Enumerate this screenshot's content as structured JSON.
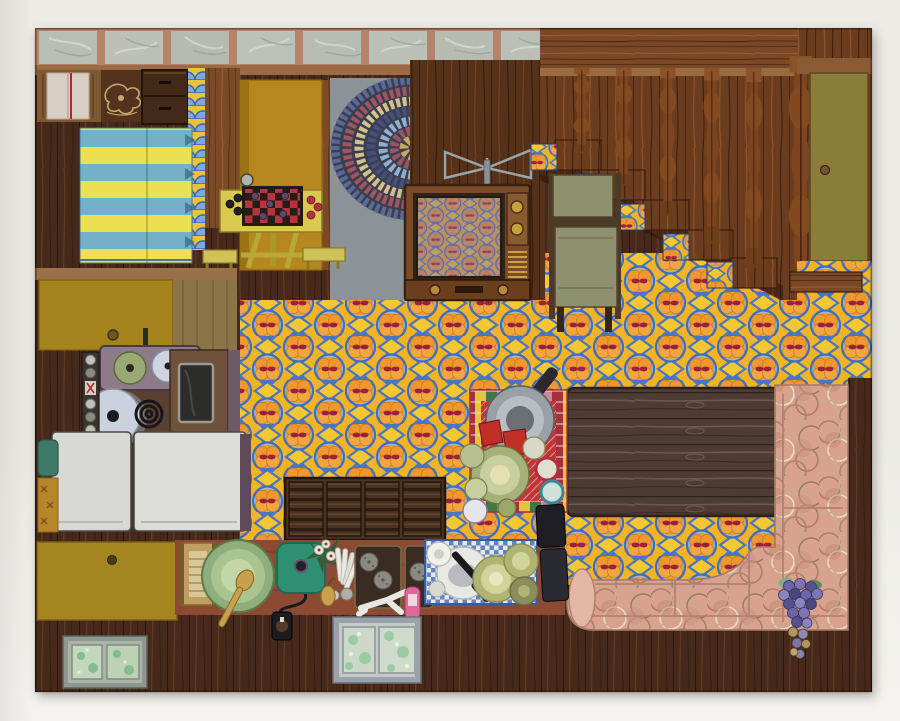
{
  "artwork": {
    "description": "Folk-art painting of a house interior seen from above: striped bed and checkers table in a bedroom, braided rug, wooden television, carpeted staircase with turned balusters, olive door, retro orange-and-blue patterned floor, kitchen with stove pots and white refrigerator doors, plank coffee table with dishes on a red checked mat, pink circle-patterned sectional sofa with grapes, counters with green tray, teal griddle, sink, plates and a window pane, hung on a white gallery wall.",
    "medium_hint": "painting on panel",
    "orientation": "landscape"
  },
  "palette": {
    "wall": "#ecebe6",
    "wallLower": "#f4f3ef",
    "woodDark": "#46291a",
    "woodMedium": "#7b4a27",
    "woodPanel": "#563119",
    "woodStair": "#75431f",
    "woodLanding": "#7b4826",
    "tableWood": "#4e3c34",
    "tileMarble": "#b9beb5",
    "tileGrout": "#b5836a",
    "floorYellow": "#f0b424",
    "floorOrange": "#ee9d2f",
    "floorBlue": "#4a74c4",
    "floorRed": "#9c1f3c",
    "bedTeal": "#74b0c8",
    "bedYellow": "#ecdf52",
    "mustardBed": "#b5871c",
    "cabinetMustard": "#a5851f",
    "kitchenCounter": "#a5841e",
    "grayFloor": "#8b9398",
    "fridgeWhite": "#d8d8d4",
    "ovenBrown": "#6e523c",
    "burnerBox": "#8d7b89",
    "sofaPink": "#d9a28f",
    "sofaSeam": "#b3806e",
    "counterRed": "#8c4a33",
    "griddleTeal": "#2f8f72",
    "trayGreen": "#a9c490",
    "checkerTableYellow": "#d9c94e",
    "checkerRed": "#b53440",
    "checkerBlack": "#281c14",
    "trivetRed": "#c23535",
    "doorOlive": "#8c7c3a",
    "chairOlive": "#8f9070",
    "grapeViolet": "#6a64a8",
    "frameGray": "#8e988e",
    "windowGray": "#9ca2aa",
    "panGray": "#9aa0a6",
    "rugBlue": "#5a6a94",
    "rugRed": "#a05560",
    "rugCream": "#d2c08a"
  },
  "scene": {
    "items": [
      {
        "name": "tiled-ledge",
        "label": "marble tile ledge"
      },
      {
        "name": "dresser-with-towel",
        "label": "dresser with towel"
      },
      {
        "name": "carved-panel",
        "label": "carved wood panel"
      },
      {
        "name": "nightstand",
        "label": "nightstand"
      },
      {
        "name": "striped-bed",
        "label": "blue and yellow striped bed"
      },
      {
        "name": "mustard-bed",
        "label": "mustard bedspread"
      },
      {
        "name": "checkers-table",
        "label": "checkers game table with benches"
      },
      {
        "name": "braided-rug",
        "label": "oval braided rug"
      },
      {
        "name": "television",
        "label": "wooden television with antenna"
      },
      {
        "name": "staircase",
        "label": "staircase with turned balusters"
      },
      {
        "name": "folding-chair",
        "label": "olive folding chair"
      },
      {
        "name": "door",
        "label": "olive door"
      },
      {
        "name": "patterned-floor",
        "label": "orange and blue retro floor"
      },
      {
        "name": "kitchen-stove",
        "label": "stove with pots"
      },
      {
        "name": "refrigerator",
        "label": "white refrigerator doors"
      },
      {
        "name": "coffee-table",
        "label": "dark plank table"
      },
      {
        "name": "red-trivet-mat",
        "label": "red checked mat with dishes"
      },
      {
        "name": "pink-sofa",
        "label": "pink sectional sofa"
      },
      {
        "name": "grapes",
        "label": "bunch of grapes"
      },
      {
        "name": "counter-items",
        "label": "counter with tray, griddle, sink, plates"
      },
      {
        "name": "window-pane",
        "label": "window pane"
      },
      {
        "name": "picture-frame",
        "label": "framed pictures"
      }
    ]
  }
}
